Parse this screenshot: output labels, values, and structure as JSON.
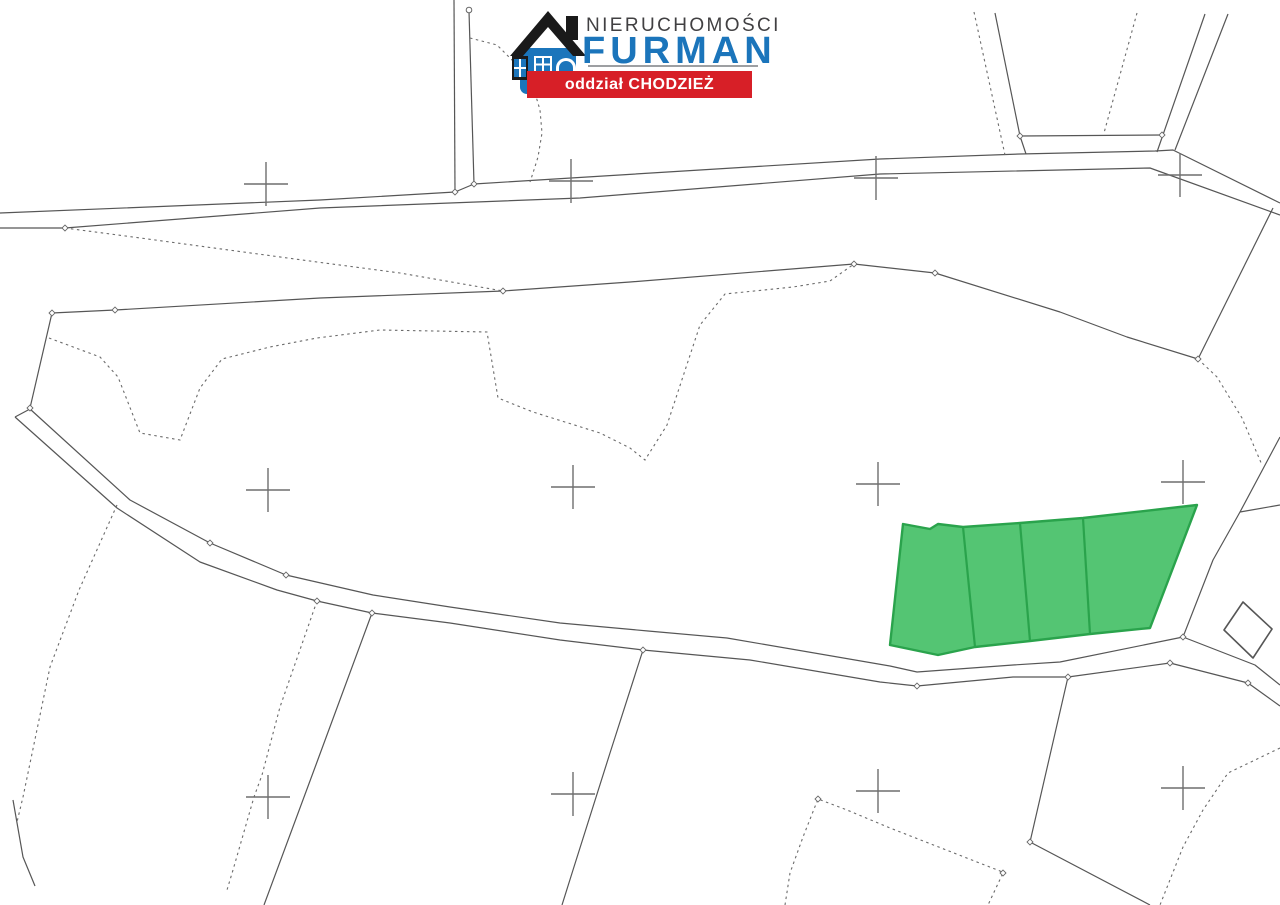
{
  "logo": {
    "line1": "NIERUCHOMOŚCI",
    "line2": "FURMAN",
    "banner": "oddział CHODZIEŻ",
    "colors": {
      "text": "#414042",
      "brand_blue": "#1b75bb",
      "banner_red": "#d71f27",
      "banner_text": "#ffffff",
      "underline": "#9d9fa2",
      "roof_black": "#1a1a1a"
    }
  },
  "map": {
    "background": "#ffffff",
    "line_color": "#565656",
    "dotted_color": "#6b6b6b",
    "cross_color": "#6e6e6e",
    "node_color": "#666666",
    "highlight": {
      "fill": "#54c573",
      "stroke": "#2aa34c",
      "parcel_count": 4
    },
    "solid_lines": [
      {
        "name": "road-upper-north-line",
        "points": [
          [
            0,
            213
          ],
          [
            320,
            200
          ],
          [
            455,
            192
          ],
          [
            474,
            184
          ],
          [
            700,
            170
          ],
          [
            880,
            159
          ],
          [
            1020,
            154
          ],
          [
            1155,
            151
          ],
          [
            1173,
            150
          ],
          [
            1280,
            203
          ]
        ]
      },
      {
        "name": "road-upper-south-line",
        "points": [
          [
            0,
            228
          ],
          [
            65,
            228
          ],
          [
            320,
            208
          ],
          [
            580,
            198
          ],
          [
            880,
            174
          ],
          [
            1150,
            168
          ],
          [
            1280,
            215
          ]
        ]
      },
      {
        "name": "top-vertical-boundary-left",
        "points": [
          [
            454,
            0
          ],
          [
            455,
            192
          ]
        ]
      },
      {
        "name": "top-vertical-boundary-right",
        "points": [
          [
            469,
            11
          ],
          [
            474,
            184
          ]
        ]
      },
      {
        "name": "north-funnel-left-boundary",
        "points": [
          [
            995,
            13
          ],
          [
            1020,
            136
          ],
          [
            1026,
            154
          ]
        ]
      },
      {
        "name": "north-funnel-base-line",
        "points": [
          [
            1020,
            136
          ],
          [
            1162,
            135
          ]
        ]
      },
      {
        "name": "north-funnel-right-boundary-a",
        "points": [
          [
            1205,
            14
          ],
          [
            1157,
            152
          ]
        ]
      },
      {
        "name": "north-funnel-right-boundary-b",
        "points": [
          [
            1228,
            14
          ],
          [
            1175,
            150
          ]
        ]
      },
      {
        "name": "east-upper-boundary",
        "points": [
          [
            1273,
            208
          ],
          [
            1198,
            359
          ]
        ]
      },
      {
        "name": "central-parcel-north-boundary",
        "points": [
          [
            52,
            313
          ],
          [
            115,
            310
          ],
          [
            320,
            298
          ],
          [
            503,
            291
          ],
          [
            630,
            282
          ],
          [
            854,
            264
          ],
          [
            935,
            273
          ],
          [
            1060,
            312
          ],
          [
            1127,
            337
          ],
          [
            1198,
            359
          ]
        ]
      },
      {
        "name": "central-parcel-west-boundary",
        "points": [
          [
            52,
            313
          ],
          [
            30,
            408
          ]
        ]
      },
      {
        "name": "lower-road-west-cap",
        "points": [
          [
            15,
            417
          ],
          [
            30,
            409
          ]
        ]
      },
      {
        "name": "road-lower-north-line",
        "points": [
          [
            30,
            409
          ],
          [
            130,
            500
          ],
          [
            210,
            543
          ],
          [
            286,
            575
          ],
          [
            373,
            595
          ],
          [
            450,
            607
          ],
          [
            560,
            623
          ],
          [
            648,
            631
          ],
          [
            727,
            638
          ],
          [
            890,
            666
          ],
          [
            917,
            672
          ],
          [
            1013,
            665
          ],
          [
            1060,
            662
          ],
          [
            1183,
            637
          ]
        ]
      },
      {
        "name": "road-lower-south-line",
        "points": [
          [
            15,
            417
          ],
          [
            117,
            508
          ],
          [
            200,
            562
          ],
          [
            277,
            590
          ],
          [
            317,
            601
          ],
          [
            372,
            613
          ],
          [
            450,
            623
          ],
          [
            560,
            640
          ],
          [
            643,
            650
          ],
          [
            750,
            660
          ],
          [
            880,
            682
          ],
          [
            917,
            686
          ],
          [
            1013,
            677
          ],
          [
            1068,
            677
          ],
          [
            1170,
            663
          ]
        ]
      },
      {
        "name": "road-lower-northeast-exit",
        "points": [
          [
            1183,
            637
          ],
          [
            1255,
            665
          ],
          [
            1280,
            685
          ]
        ]
      },
      {
        "name": "road-lower-southeast-exit",
        "points": [
          [
            1170,
            663
          ],
          [
            1248,
            683
          ],
          [
            1280,
            706
          ]
        ]
      },
      {
        "name": "east-mid-boundary",
        "points": [
          [
            1280,
            437
          ],
          [
            1240,
            512
          ],
          [
            1213,
            560
          ],
          [
            1183,
            637
          ]
        ]
      },
      {
        "name": "east-mid-branch",
        "points": [
          [
            1240,
            512
          ],
          [
            1280,
            505
          ]
        ]
      },
      {
        "name": "south-field-boundary-1",
        "points": [
          [
            643,
            650
          ],
          [
            610,
            753
          ],
          [
            573,
            870
          ],
          [
            562,
            905
          ]
        ]
      },
      {
        "name": "south-field-boundary-2",
        "points": [
          [
            372,
            613
          ],
          [
            317,
            762
          ],
          [
            264,
            905
          ]
        ]
      },
      {
        "name": "southeast-field-boundary",
        "points": [
          [
            1068,
            677
          ],
          [
            1030,
            842
          ],
          [
            1150,
            905
          ]
        ]
      },
      {
        "name": "bottom-left-boundary",
        "points": [
          [
            13,
            800
          ],
          [
            23,
            857
          ],
          [
            35,
            886
          ]
        ]
      }
    ],
    "dotted_lines": [
      {
        "name": "dotted-diagonal-from-road",
        "points": [
          [
            65,
            228
          ],
          [
            133,
            237
          ],
          [
            317,
            262
          ],
          [
            400,
            273
          ],
          [
            503,
            291
          ]
        ]
      },
      {
        "name": "dotted-interior-field-boundary",
        "points": [
          [
            49,
            338
          ],
          [
            100,
            357
          ],
          [
            118,
            377
          ],
          [
            140,
            433
          ],
          [
            180,
            440
          ],
          [
            200,
            388
          ],
          [
            222,
            359
          ],
          [
            270,
            347
          ],
          [
            317,
            338
          ],
          [
            380,
            330
          ],
          [
            487,
            332
          ],
          [
            492,
            362
          ],
          [
            498,
            398
          ],
          [
            533,
            412
          ],
          [
            600,
            433
          ],
          [
            630,
            448
          ],
          [
            645,
            460
          ],
          [
            667,
            425
          ],
          [
            700,
            325
          ],
          [
            725,
            294
          ],
          [
            793,
            287
          ],
          [
            830,
            281
          ],
          [
            854,
            264
          ]
        ]
      },
      {
        "name": "dotted-arc-under-logo",
        "points": [
          [
            470,
            38
          ],
          [
            497,
            45
          ],
          [
            512,
            60
          ],
          [
            527,
            75
          ],
          [
            535,
            93
          ],
          [
            540,
            110
          ],
          [
            542,
            133
          ],
          [
            538,
            157
          ],
          [
            533,
            173
          ],
          [
            530,
            182
          ]
        ]
      },
      {
        "name": "dotted-north-funnel-left",
        "points": [
          [
            974,
            12
          ],
          [
            1005,
            155
          ]
        ]
      },
      {
        "name": "dotted-north-funnel-inner",
        "points": [
          [
            1137,
            13
          ],
          [
            1104,
            133
          ]
        ]
      },
      {
        "name": "dotted-east-boundary",
        "points": [
          [
            1198,
            359
          ],
          [
            1217,
            377
          ],
          [
            1242,
            418
          ],
          [
            1262,
            465
          ]
        ]
      },
      {
        "name": "dotted-far-left-boundary",
        "points": [
          [
            117,
            505
          ],
          [
            79,
            590
          ],
          [
            50,
            667
          ],
          [
            23,
            797
          ],
          [
            17,
            822
          ]
        ]
      },
      {
        "name": "dotted-south-boundary",
        "points": [
          [
            317,
            601
          ],
          [
            280,
            707
          ],
          [
            262,
            775
          ],
          [
            254,
            797
          ],
          [
            233,
            870
          ],
          [
            227,
            890
          ]
        ]
      },
      {
        "name": "dotted-bottom-center-boundary",
        "points": [
          [
            785,
            905
          ],
          [
            790,
            873
          ],
          [
            803,
            837
          ],
          [
            818,
            799
          ],
          [
            847,
            810
          ],
          [
            890,
            828
          ],
          [
            1000,
            871
          ],
          [
            1003,
            873
          ],
          [
            988,
            905
          ]
        ]
      },
      {
        "name": "dotted-bottom-right-boundary",
        "points": [
          [
            1280,
            748
          ],
          [
            1228,
            773
          ],
          [
            1203,
            810
          ],
          [
            1183,
            847
          ],
          [
            1160,
            905
          ]
        ]
      }
    ],
    "building": {
      "name": "small-building-outline",
      "points": [
        [
          1224,
          630
        ],
        [
          1243,
          602
        ],
        [
          1272,
          629
        ],
        [
          1253,
          658
        ]
      ]
    },
    "green_area": {
      "outline": [
        [
          903,
          524
        ],
        [
          930,
          529
        ],
        [
          938,
          524
        ],
        [
          963,
          527
        ],
        [
          1020,
          523
        ],
        [
          1083,
          518
        ],
        [
          1197,
          505
        ],
        [
          1150,
          628
        ],
        [
          1090,
          634
        ],
        [
          1030,
          641
        ],
        [
          975,
          647
        ],
        [
          938,
          655
        ],
        [
          890,
          645
        ]
      ],
      "dividers": [
        [
          [
            963,
            527
          ],
          [
            975,
            647
          ]
        ],
        [
          [
            1020,
            523
          ],
          [
            1030,
            641
          ]
        ],
        [
          [
            1083,
            518
          ],
          [
            1090,
            634
          ]
        ]
      ]
    },
    "crosses": [
      [
        266,
        184
      ],
      [
        571,
        181
      ],
      [
        876,
        178
      ],
      [
        1180,
        175
      ],
      [
        268,
        490
      ],
      [
        573,
        487
      ],
      [
        878,
        484
      ],
      [
        1183,
        482
      ],
      [
        268,
        797
      ],
      [
        573,
        794
      ],
      [
        878,
        791
      ],
      [
        1183,
        788
      ]
    ],
    "nodes": [
      [
        65,
        228
      ],
      [
        455,
        192
      ],
      [
        474,
        184
      ],
      [
        503,
        291
      ],
      [
        854,
        264
      ],
      [
        935,
        273
      ],
      [
        1198,
        359
      ],
      [
        52,
        313
      ],
      [
        115,
        310
      ],
      [
        30,
        408
      ],
      [
        210,
        543
      ],
      [
        286,
        575
      ],
      [
        317,
        601
      ],
      [
        372,
        613
      ],
      [
        643,
        650
      ],
      [
        917,
        686
      ],
      [
        1068,
        677
      ],
      [
        1170,
        663
      ],
      [
        1183,
        637
      ],
      [
        1248,
        683
      ],
      [
        1030,
        842
      ],
      [
        1020,
        136
      ],
      [
        1162,
        135
      ],
      [
        818,
        799
      ],
      [
        1003,
        873
      ]
    ],
    "circle_markers": [
      [
        469,
        10
      ]
    ]
  }
}
